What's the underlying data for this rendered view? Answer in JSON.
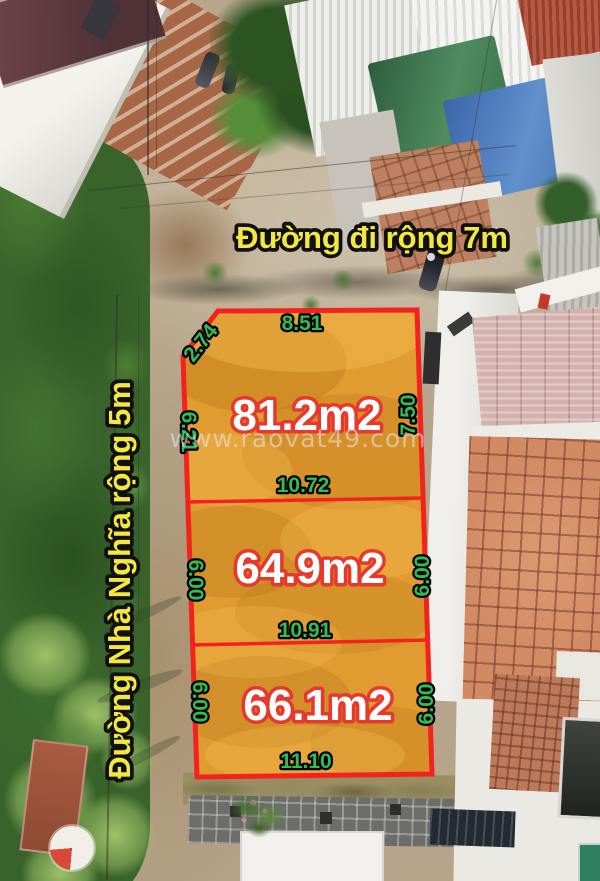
{
  "roads": {
    "top_label": "Đường đi rộng 7m",
    "left_label": "Đường Nhà Nghĩa rộng 5m"
  },
  "watermark": "www.raovat49.com",
  "plots": [
    {
      "area": "81.2m2",
      "top": "8.51",
      "corner": "2.74",
      "left": "6.21",
      "right": "7.50",
      "bottom": "10.72"
    },
    {
      "area": "64.9m2",
      "left": "6.00",
      "right": "6.00",
      "bottom": "10.91"
    },
    {
      "area": "66.1m2",
      "left": "6.00",
      "right": "6.00",
      "bottom": "11.10"
    }
  ],
  "colors": {
    "plot_fill": "#E09B31",
    "plot_border": "#F3221F",
    "dimension_text": "#2EBE52",
    "area_text": "#FFFFFF",
    "area_text_outline": "#E6392B",
    "road_text": "#F2E83E",
    "road_text_outline": "#101010",
    "watermark_text": "#E8E8E8"
  }
}
